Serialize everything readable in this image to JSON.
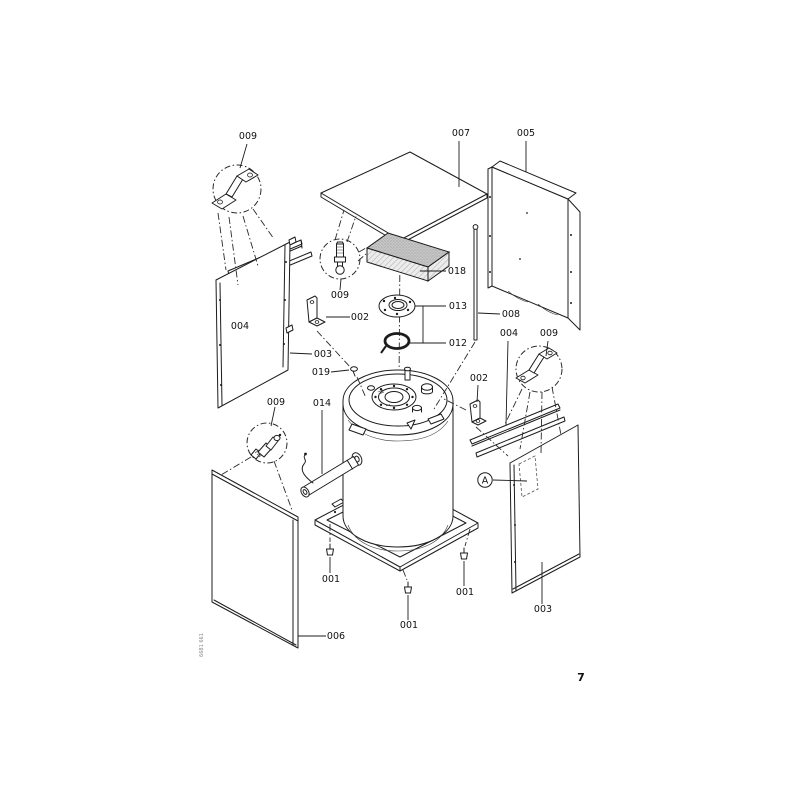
{
  "figure": {
    "page_number": "7",
    "doc_code": "6681 661",
    "detail_marker": "A"
  },
  "labels": {
    "l001": "001",
    "l002": "002",
    "l003": "003",
    "l004": "004",
    "l005": "005",
    "l006": "006",
    "l007": "007",
    "l008": "008",
    "l009": "009",
    "l012": "012",
    "l013": "013",
    "l014": "014",
    "l018": "018",
    "l019": "019"
  }
}
